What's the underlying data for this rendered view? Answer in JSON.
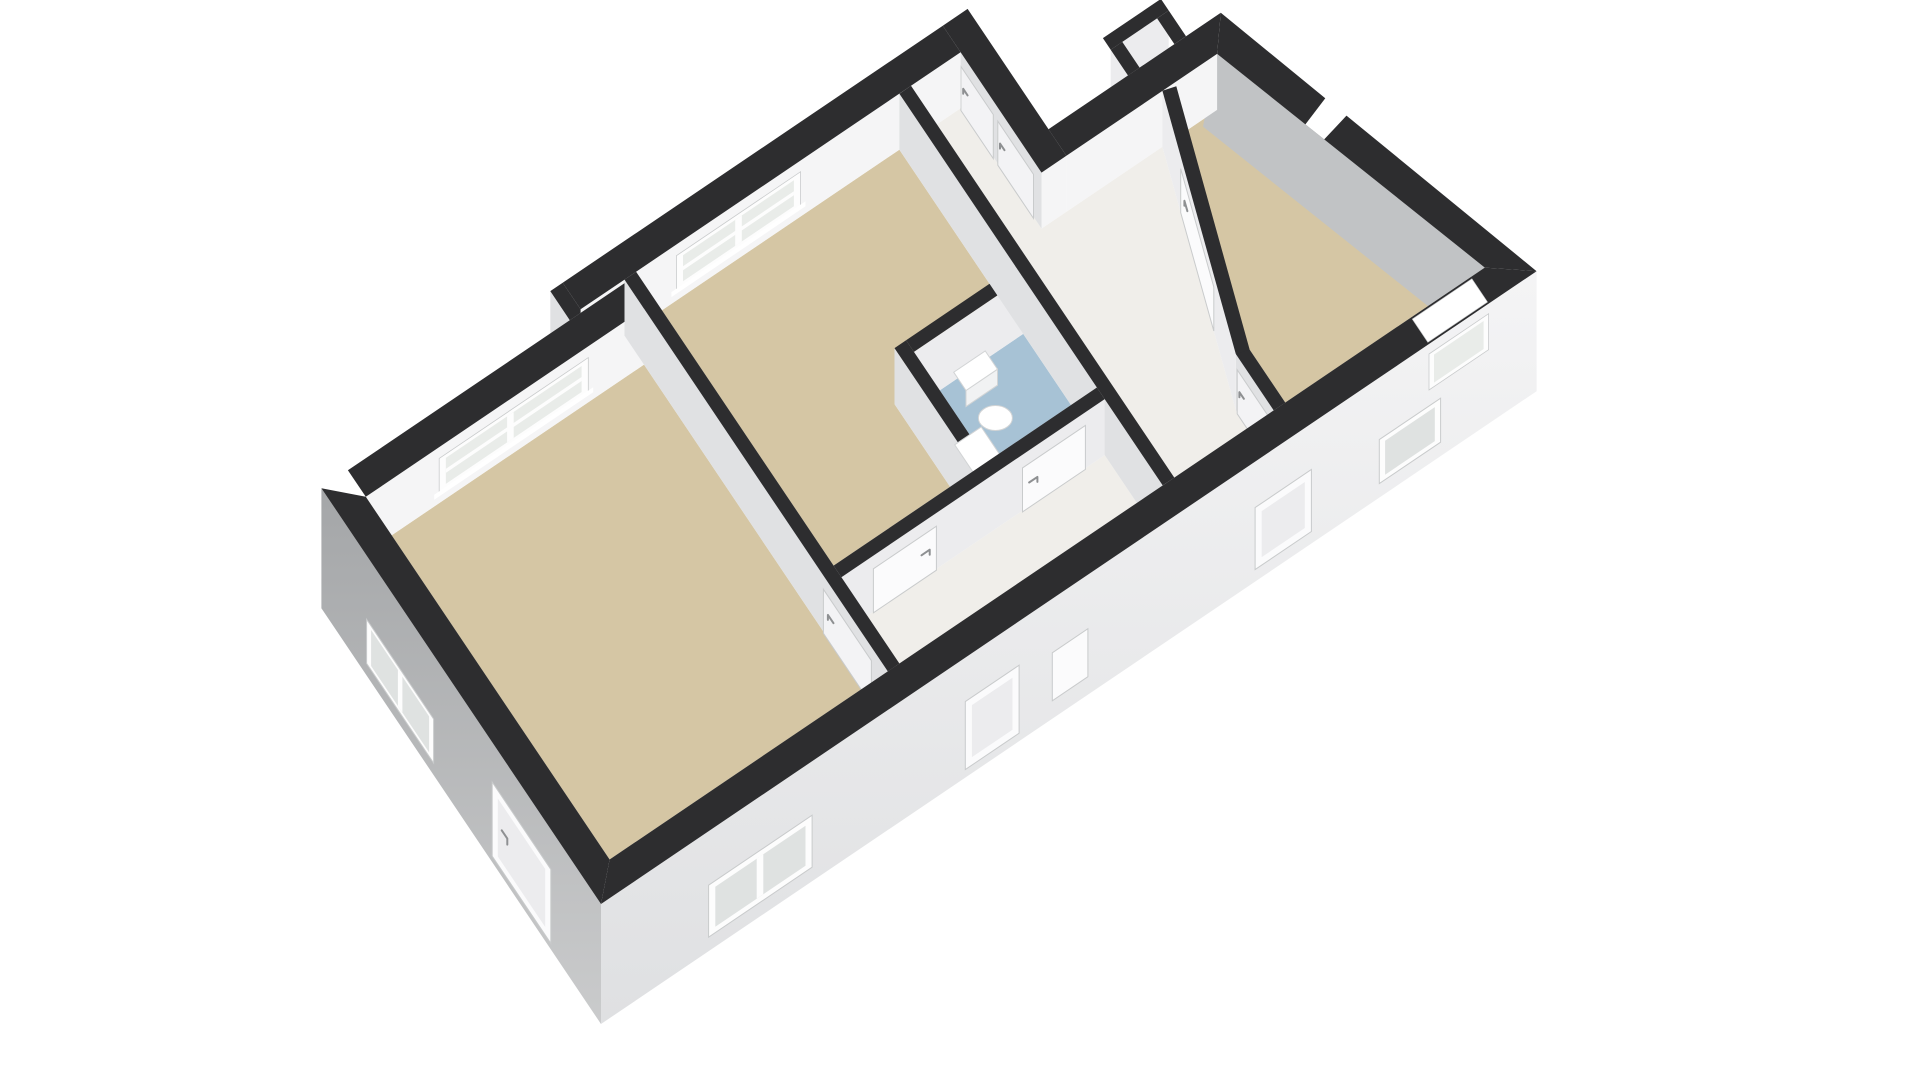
{
  "scene": {
    "kind": "3d-floorplan-render",
    "view": "isometric-birdseye",
    "background": "#ffffff",
    "canvas": {
      "width": 1920,
      "height": 1080
    }
  },
  "palette": {
    "band": "#2d2d2f",
    "faceBright": "#f5f5f6",
    "faceSoft": "#ececee",
    "faceShade": "#e0e1e3",
    "faceGray": "#c1c3c5",
    "backer": "#f1f1f2",
    "extSWTop": "#a4a6a8",
    "extSWBottom": "#cacbcc",
    "extSETop": "#f4f4f5",
    "extSEBottom": "#dfe0e2",
    "floorRoom": "#d5c6a4",
    "floorWC": "#a7c2d5",
    "floorHall": "#f0eeea",
    "frame": "#fdfdfd",
    "glass": "#e9ece9",
    "glassDark": "#dfe2e1",
    "panel": "#fbfbfc",
    "panelShade": "#f3f3f5",
    "line": "#c9cbcc",
    "handle": "#8e9092",
    "white": "#ffffff",
    "fixture": "#ffffff",
    "fixtureShade": "#f1f2f3",
    "fixtureLine": "#d2d4d5"
  },
  "rooms": [
    {
      "id": "bedroom-left",
      "floor": "floorRoom"
    },
    {
      "id": "bedroom-middle",
      "floor": "floorRoom"
    },
    {
      "id": "bedroom-right",
      "floor": "floorRoom"
    },
    {
      "id": "hallway",
      "floor": "floorHall"
    },
    {
      "id": "entry",
      "floor": "floorHall"
    },
    {
      "id": "wc",
      "floor": "floorWC"
    },
    {
      "id": "closet-nook",
      "floor": "floorHall"
    }
  ],
  "fixtures": [
    "toilet",
    "sink"
  ],
  "openings": {
    "interior_doors": 7,
    "exterior_doors": 3,
    "windows": 7,
    "wall_gap": 1
  }
}
